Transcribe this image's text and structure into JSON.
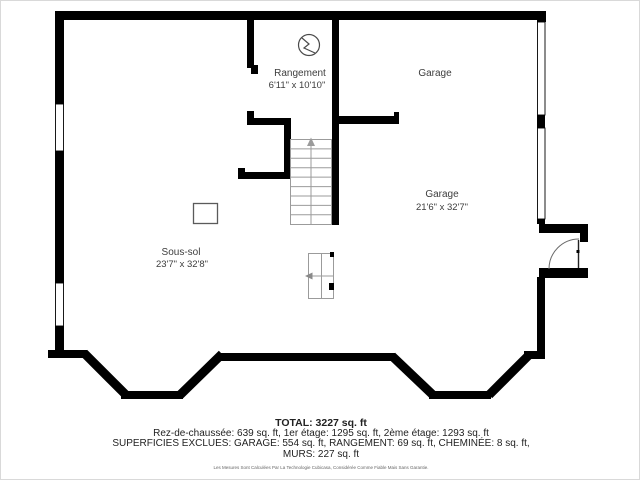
{
  "plan": {
    "rooms": {
      "rangement": {
        "name": "Rangement",
        "dims": "6'11\" x 10'10\""
      },
      "garage_upper": {
        "name": "Garage"
      },
      "garage": {
        "name": "Garage",
        "dims": "21'6\" x 32'7\""
      },
      "sous_sol": {
        "name": "Sous-sol",
        "dims": "23'7\" x 32'8\""
      }
    },
    "icons": {
      "lightning_circle": "circle-with-zigzag utility symbol",
      "column_post": "square structural post",
      "stairs_arrow": "up-direction arrow on staircase",
      "entry_door": "quarter-arc door swing"
    },
    "colors": {
      "wall": "#000000",
      "stairs": "#9b9b9b",
      "label": "#3d3d3d",
      "background": "#ffffff"
    }
  },
  "footer": {
    "total": "TOTAL: 3227 sq. ft",
    "floors": "Rez-de-chaussée: 639 sq. ft, 1er étage: 1295 sq. ft, 2ème étage: 1293 sq. ft",
    "exclusions": "SUPERFICIES EXCLUES: GARAGE: 554 sq. ft, RANGEMENT: 69 sq. ft, CHEMINÉE: 8 sq. ft,",
    "walls": "MURS: 227 sq. ft",
    "disclaimer": "Les Mesures Sont Calculées Par La Technologie Cubicasa, Considérée Comme Fiable Mais Sans Garantie."
  }
}
